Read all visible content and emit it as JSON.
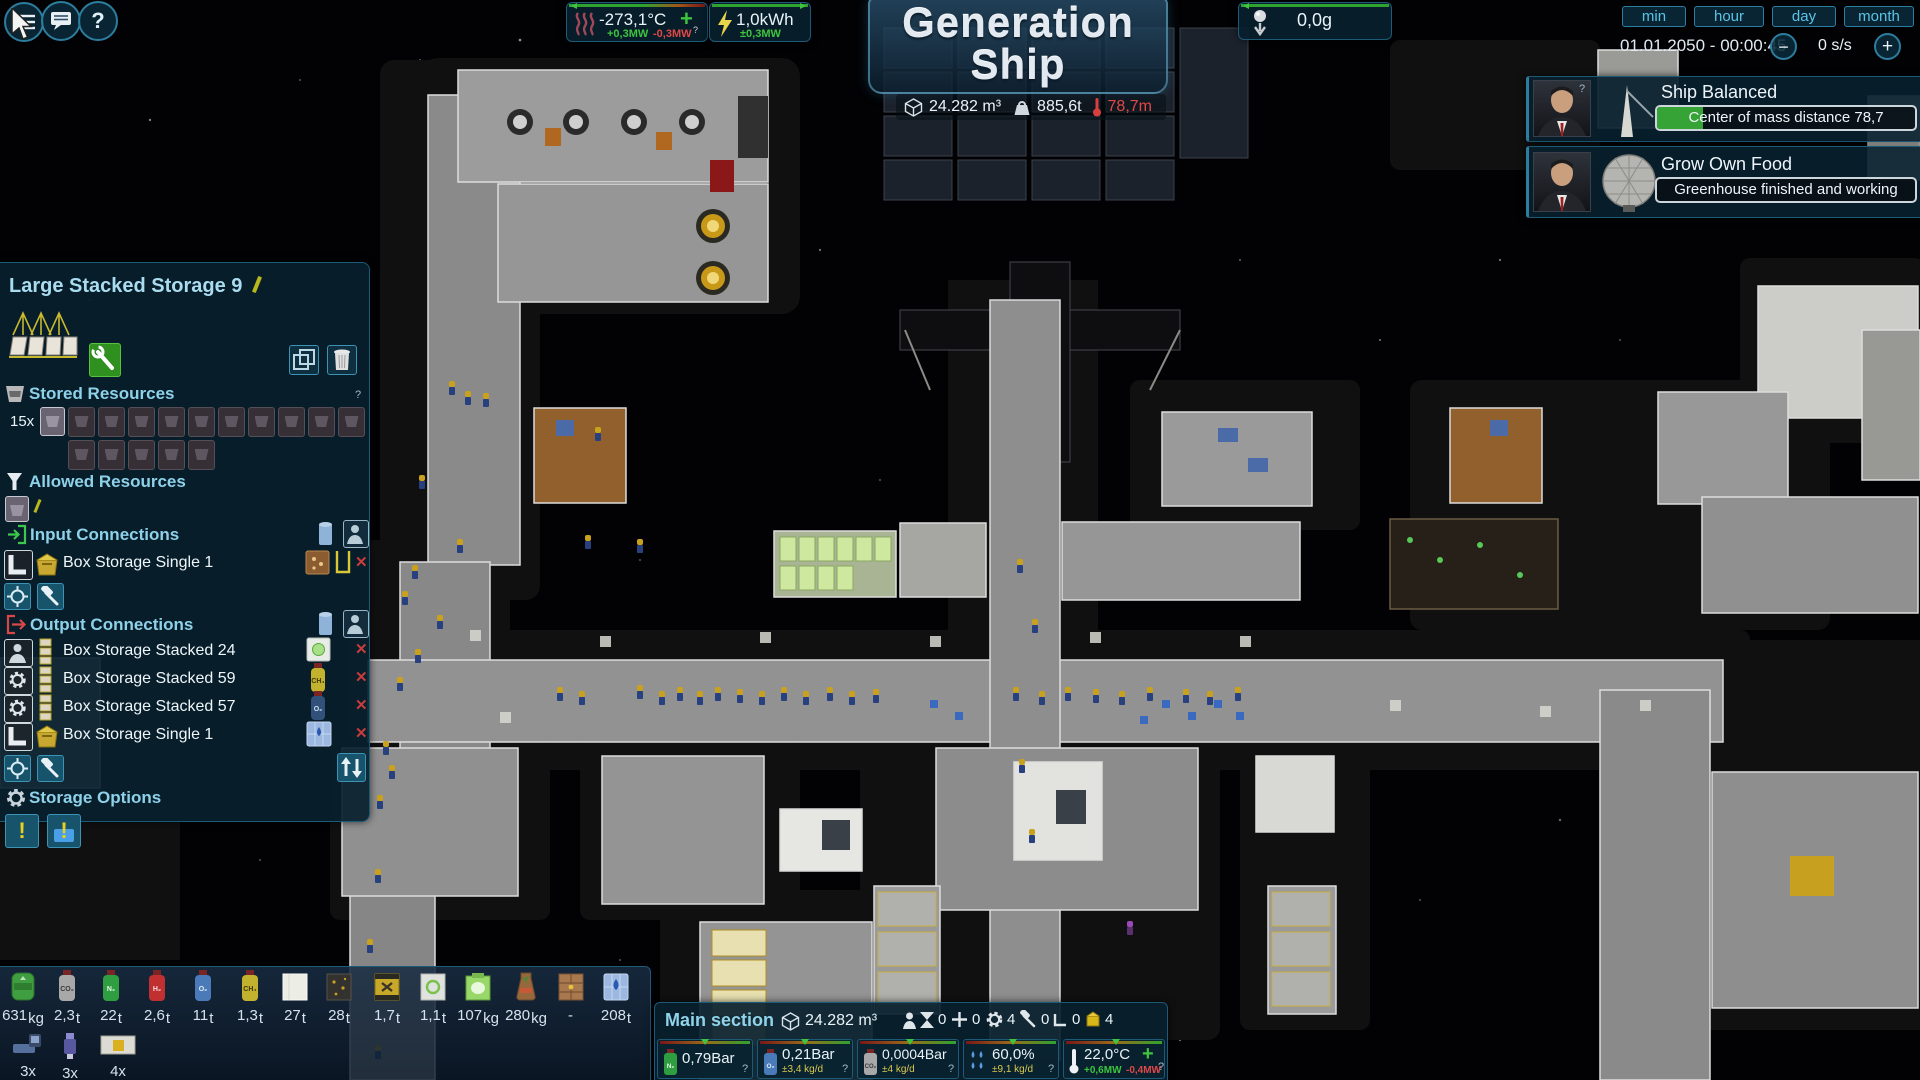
{
  "colors": {
    "accent_teal": "#2d7d9e",
    "text_cyan": "#5ac4e6",
    "positive_green": "#3ec43e",
    "negative_red": "#e04848",
    "warn_yellow": "#d8ca4e",
    "progress_green": "#36a336"
  },
  "topbar": {
    "help_label": "?",
    "temperature": {
      "value": "-273,1°C",
      "plus": "+",
      "gain": "+0,3MW",
      "loss": "-0,3MW",
      "q": "?"
    },
    "energy": {
      "value": "1,0kWh",
      "delta": "±0,3MW"
    },
    "title_line1": "Generation",
    "title_line2": "Ship",
    "ship_stats": {
      "volume": "24.282 m³",
      "mass": "885,6t",
      "length": "78,7m"
    },
    "gravity": "0,0g",
    "time": {
      "buttons": [
        "min",
        "hour",
        "day",
        "month"
      ],
      "datetime": "01.01.2050 - 00:00:45",
      "speed": "0 s/s",
      "minus": "−",
      "plus": "+"
    }
  },
  "notifications": [
    {
      "title": "Ship Balanced",
      "detail": "Center of mass distance 78,7",
      "q": "?",
      "progress_pct": 18
    },
    {
      "title": "Grow Own Food",
      "detail": "Greenhouse finished and working",
      "progress_pct": 0
    }
  ],
  "storage_panel": {
    "title": "Large Stacked Storage 9",
    "stored_header": "Stored Resources",
    "stored_q": "?",
    "stored_count": "15x",
    "slots_row1": 10,
    "slots_row2": 5,
    "allowed_header": "Allowed Resources",
    "input_header": "Input Connections",
    "input_rows": [
      {
        "label": "Box Storage Single 1"
      }
    ],
    "output_header": "Output Connections",
    "output_rows": [
      {
        "label": "Box Storage Stacked 24"
      },
      {
        "label": "Box Storage Stacked 59"
      },
      {
        "label": "Box Storage Stacked 57"
      },
      {
        "label": "Box Storage Single 1"
      }
    ],
    "options_header": "Storage Options",
    "close_x": "✕"
  },
  "resource_bar": {
    "items": [
      {
        "amount": "631",
        "unit": "kg",
        "label": ""
      },
      {
        "amount": "2,3",
        "unit": "t",
        "label": "CO₂"
      },
      {
        "amount": "22",
        "unit": "t",
        "label": "N₂"
      },
      {
        "amount": "2,6",
        "unit": "t",
        "label": "H₂"
      },
      {
        "amount": "11",
        "unit": "t",
        "label": "O₂"
      },
      {
        "amount": "1,3",
        "unit": "t",
        "label": "CH₄"
      },
      {
        "amount": "27",
        "unit": "t",
        "label": ""
      },
      {
        "amount": "28",
        "unit": "t",
        "label": ""
      },
      {
        "amount": "1,7",
        "unit": "t",
        "label": ""
      },
      {
        "amount": "1,1",
        "unit": "t",
        "label": ""
      },
      {
        "amount": "107",
        "unit": "kg",
        "label": ""
      },
      {
        "amount": "280",
        "unit": "kg",
        "label": ""
      },
      {
        "amount": "-",
        "unit": "",
        "label": ""
      },
      {
        "amount": "208",
        "unit": "t",
        "label": ""
      }
    ],
    "machines": [
      {
        "count": "3x"
      },
      {
        "count": "3x"
      },
      {
        "count": "4x"
      }
    ]
  },
  "main_section": {
    "title": "Main section",
    "volume": "24.282 m³",
    "counters": {
      "crew": "0",
      "cross": "0",
      "gear": "4",
      "hammer": "0",
      "corner": "0",
      "box": "4"
    },
    "env": [
      {
        "value": "0,79Bar",
        "delta": "",
        "q": "?"
      },
      {
        "value": "0,21Bar",
        "delta": "±3,4 kg/d",
        "q": "?"
      },
      {
        "value": "0,0004Bar",
        "delta": "±4 kg/d",
        "q": "?"
      },
      {
        "value": "60,0%",
        "delta": "±9,1 kg/d",
        "q": "?"
      },
      {
        "value": "22,0°C",
        "plus": "+",
        "gain": "+0,6MW",
        "loss": "-0,4MW",
        "q": "?"
      }
    ]
  }
}
